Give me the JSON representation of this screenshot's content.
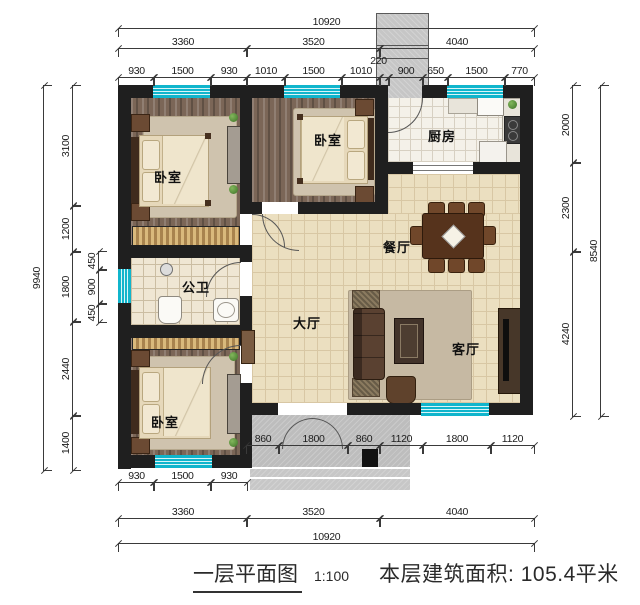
{
  "caption": {
    "title": "一层平面图",
    "scale": "1:100",
    "area": "本层建筑面积: 105.4平米"
  },
  "colors": {
    "wall": "#1f1f1f",
    "window_accent": "#10b5cc",
    "hall_tile": "#ebdfc0",
    "wood_floor": "#7b6657",
    "porch_concrete": "#bdbdbd"
  },
  "rooms": [
    {
      "id": "bedroom-top-left",
      "label": "卧室",
      "x": 154,
      "y": 167
    },
    {
      "id": "bedroom-top-middle",
      "label": "卧室",
      "x": 314,
      "y": 130
    },
    {
      "id": "kitchen",
      "label": "厨房",
      "x": 428,
      "y": 126
    },
    {
      "id": "bathroom",
      "label": "公卫",
      "x": 182,
      "y": 277
    },
    {
      "id": "dining-room",
      "label": "餐厅",
      "x": 383,
      "y": 237
    },
    {
      "id": "main-hall",
      "label": "大厅",
      "x": 293,
      "y": 313
    },
    {
      "id": "living-room",
      "label": "客厅",
      "x": 452,
      "y": 339
    },
    {
      "id": "bedroom-bottom-left",
      "label": "卧室",
      "x": 151,
      "y": 412
    }
  ],
  "dims": [
    {
      "v": "10920",
      "o": "h",
      "x": 118,
      "y": 28,
      "l": 415
    },
    {
      "v": "3360",
      "o": "h",
      "x": 118,
      "y": 48,
      "l": 128
    },
    {
      "v": "3520",
      "o": "h",
      "x": 246,
      "y": 48,
      "l": 133
    },
    {
      "v": "4040",
      "o": "h",
      "x": 379,
      "y": 48,
      "l": 154
    },
    {
      "v": "930",
      "o": "h",
      "x": 118,
      "y": 77,
      "l": 35
    },
    {
      "v": "1500",
      "o": "h",
      "x": 153,
      "y": 77,
      "l": 57
    },
    {
      "v": "930",
      "o": "h",
      "x": 210,
      "y": 77,
      "l": 36
    },
    {
      "v": "1010",
      "o": "h",
      "x": 246,
      "y": 77,
      "l": 38
    },
    {
      "v": "1500",
      "o": "h",
      "x": 284,
      "y": 77,
      "l": 57
    },
    {
      "v": "1010",
      "o": "h",
      "x": 341,
      "y": 77,
      "l": 38
    },
    {
      "v": "220",
      "o": "h",
      "x": 379,
      "y": 77,
      "l": 9,
      "dx": -6,
      "dy": -10
    },
    {
      "v": "900",
      "o": "h",
      "x": 388,
      "y": 77,
      "l": 34
    },
    {
      "v": "650",
      "o": "h",
      "x": 422,
      "y": 77,
      "l": 25
    },
    {
      "v": "1500",
      "o": "h",
      "x": 447,
      "y": 77,
      "l": 57
    },
    {
      "v": "770",
      "o": "h",
      "x": 504,
      "y": 77,
      "l": 29
    },
    {
      "v": "860",
      "o": "h",
      "x": 246,
      "y": 445,
      "l": 32
    },
    {
      "v": "1800",
      "o": "h",
      "x": 278,
      "y": 445,
      "l": 69
    },
    {
      "v": "860",
      "o": "h",
      "x": 347,
      "y": 445,
      "l": 32
    },
    {
      "v": "1120",
      "o": "h",
      "x": 379,
      "y": 445,
      "l": 43
    },
    {
      "v": "1800",
      "o": "h",
      "x": 422,
      "y": 445,
      "l": 68
    },
    {
      "v": "1120",
      "o": "h",
      "x": 490,
      "y": 445,
      "l": 43
    },
    {
      "v": "930",
      "o": "h",
      "x": 118,
      "y": 482,
      "l": 35
    },
    {
      "v": "1500",
      "o": "h",
      "x": 153,
      "y": 482,
      "l": 57
    },
    {
      "v": "930",
      "o": "h",
      "x": 210,
      "y": 482,
      "l": 36
    },
    {
      "v": "3360",
      "o": "h",
      "x": 118,
      "y": 518,
      "l": 128
    },
    {
      "v": "3520",
      "o": "h",
      "x": 246,
      "y": 518,
      "l": 133
    },
    {
      "v": "4040",
      "o": "h",
      "x": 379,
      "y": 518,
      "l": 154
    },
    {
      "v": "10920",
      "o": "h",
      "x": 118,
      "y": 543,
      "l": 415
    },
    {
      "v": "9940",
      "o": "v",
      "x": 43,
      "y": 85,
      "l": 384
    },
    {
      "v": "3100",
      "o": "v",
      "x": 72,
      "y": 85,
      "l": 120
    },
    {
      "v": "1200",
      "o": "v",
      "x": 72,
      "y": 205,
      "l": 46
    },
    {
      "v": "1800",
      "o": "v",
      "x": 72,
      "y": 251,
      "l": 70
    },
    {
      "v": "2440",
      "o": "v",
      "x": 72,
      "y": 321,
      "l": 94
    },
    {
      "v": "1400",
      "o": "v",
      "x": 72,
      "y": 415,
      "l": 54
    },
    {
      "v": "450",
      "o": "v",
      "x": 98,
      "y": 251,
      "l": 18
    },
    {
      "v": "900",
      "o": "v",
      "x": 98,
      "y": 269,
      "l": 34
    },
    {
      "v": "450",
      "o": "v",
      "x": 98,
      "y": 303,
      "l": 18
    },
    {
      "v": "2000",
      "o": "v",
      "x": 572,
      "y": 85,
      "l": 77
    },
    {
      "v": "2300",
      "o": "v",
      "x": 572,
      "y": 162,
      "l": 89
    },
    {
      "v": "4240",
      "o": "v",
      "x": 572,
      "y": 251,
      "l": 164
    },
    {
      "v": "8540",
      "o": "v",
      "x": 600,
      "y": 85,
      "l": 330
    }
  ]
}
